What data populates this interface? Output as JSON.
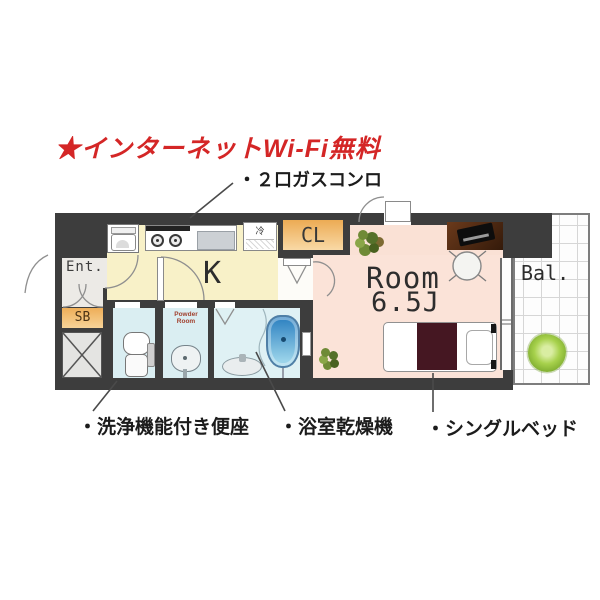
{
  "annotations": {
    "wifi": "★インターネットWi-Fi無料",
    "gas_stove": "・２口ガスコンロ",
    "washlet": "・洗浄機能付き便座",
    "bath_dryer": "・浴室乾燥機",
    "single_bed": "・シングルベッド"
  },
  "rooms": {
    "entrance": "Ent.",
    "shoe_box": "SB",
    "kitchen": "K",
    "closet": "CL",
    "refrigerator": "冷",
    "main_room_label": "Room",
    "main_room_size": "6.5J",
    "balcony": "Bal.",
    "powder_room": "Powder Room"
  },
  "colors": {
    "annotation_red": "#d42626",
    "wall": "#3d3d3d",
    "kitchen_floor": "#f8f1c8",
    "room_floor": "#fbe3d8",
    "wet_area_floor": "#daeef2",
    "entrance_floor": "#eceae6",
    "storage_orange": "#f2bc72",
    "bed_cover": "#451722",
    "bathtub_blue": "#2b7fc0",
    "balcony_plant_green": "#9cc83e"
  }
}
